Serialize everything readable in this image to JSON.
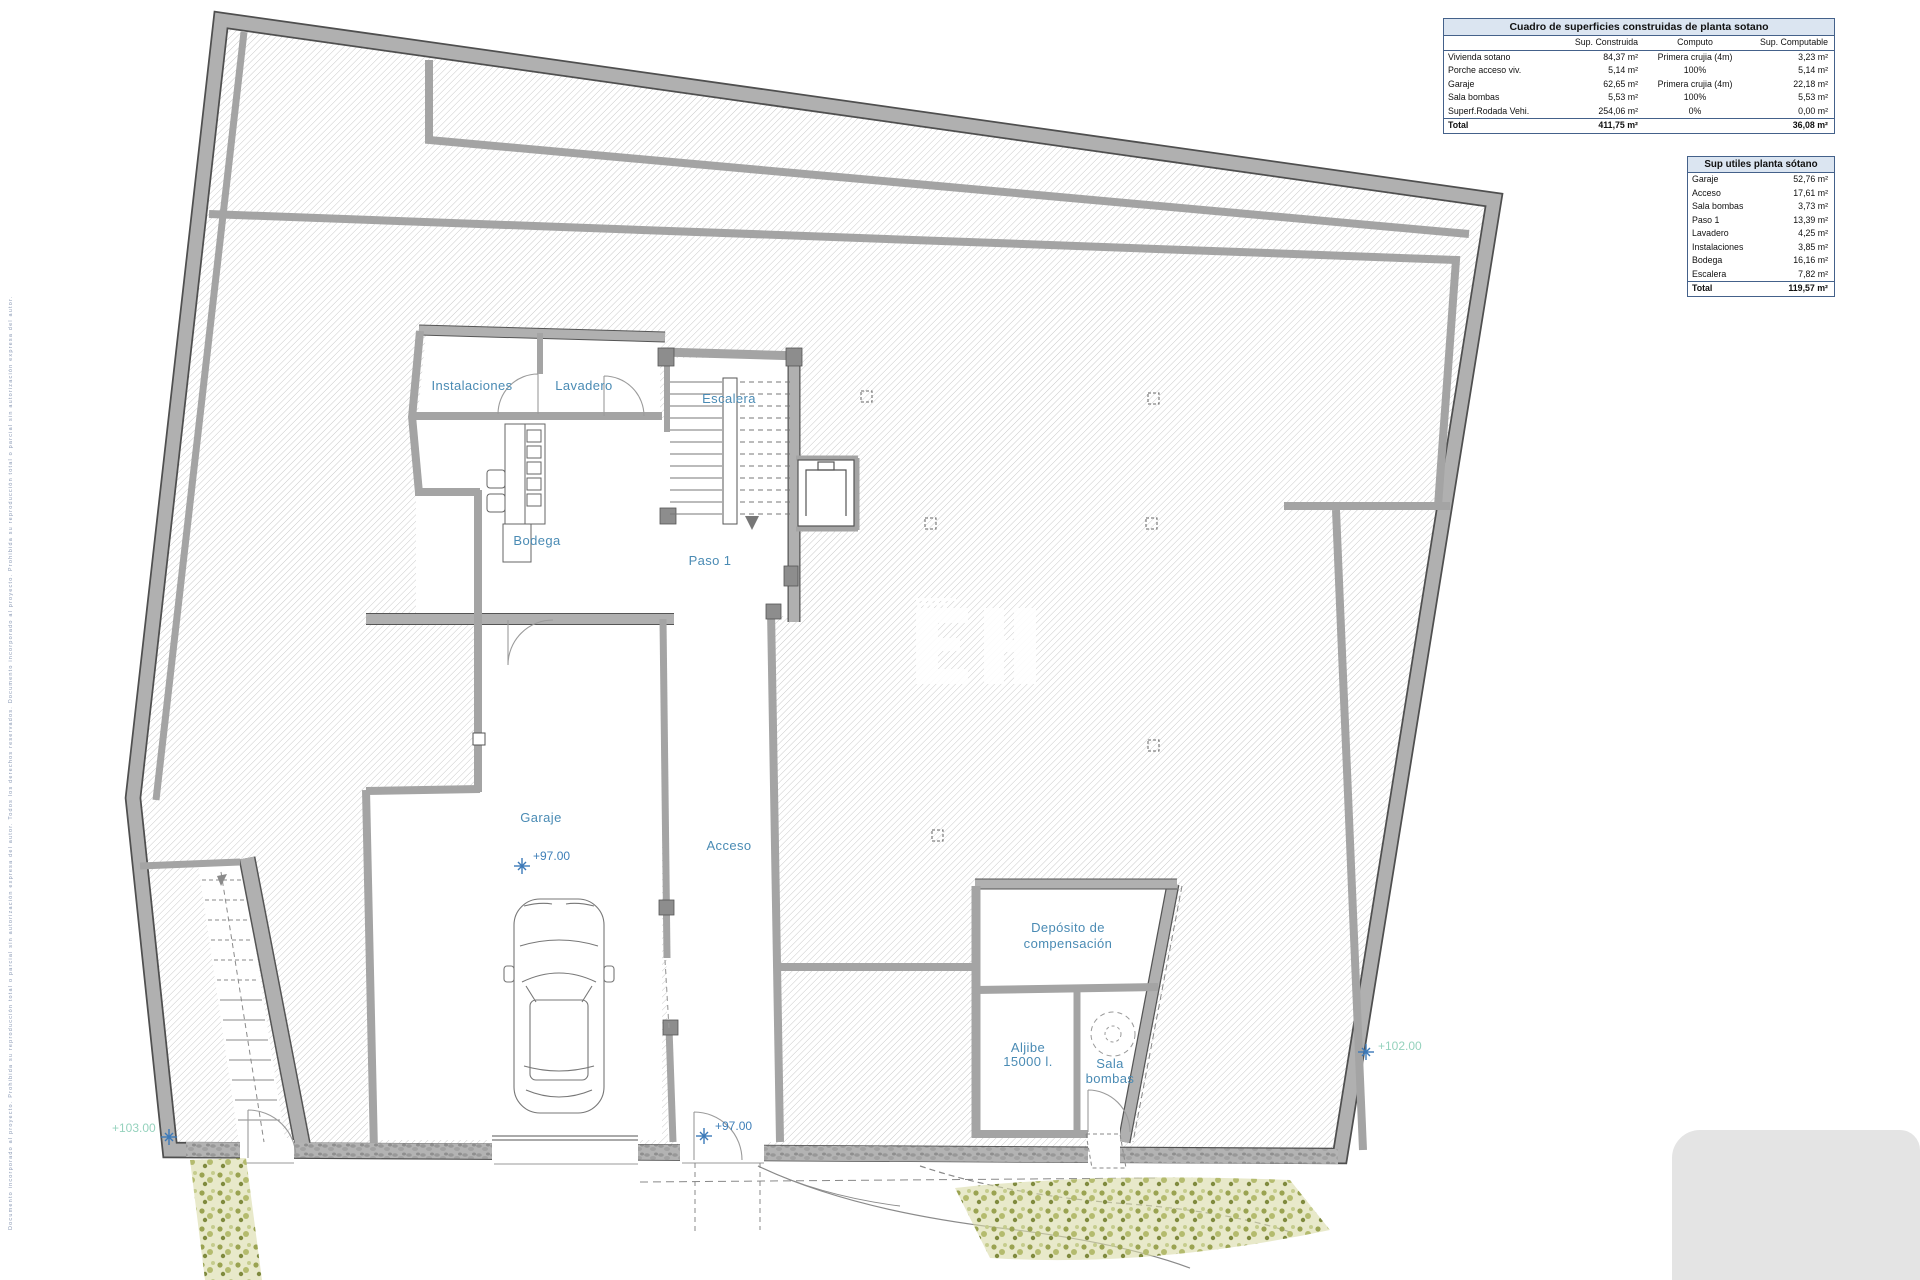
{
  "tables": {
    "t1": {
      "title": "Cuadro de superficies construidas de planta sotano",
      "headers": [
        "Sup. Construida",
        "Computo",
        "Sup. Computable"
      ],
      "rows": [
        [
          "Vivienda sotano",
          "84,37 m²",
          "Primera crujia (4m)",
          "3,23 m²"
        ],
        [
          "Porche acceso viv.",
          "5,14 m²",
          "100%",
          "5,14 m²"
        ],
        [
          "Garaje",
          "62,65 m²",
          "Primera crujia (4m)",
          "22,18 m²"
        ],
        [
          "Sala bombas",
          "5,53 m²",
          "100%",
          "5,53 m²"
        ],
        [
          "Superf.Rodada Vehi.",
          "254,06 m²",
          "0%",
          "0,00 m²"
        ]
      ],
      "total": [
        "Total",
        "411,75 m²",
        "",
        "36,08 m²"
      ]
    },
    "t2": {
      "title": "Sup utiles planta sótano",
      "rows": [
        [
          "Garaje",
          "52,76 m²"
        ],
        [
          "Acceso",
          "17,61 m²"
        ],
        [
          "Sala bombas",
          "3,73 m²"
        ],
        [
          "Paso 1",
          "13,39 m²"
        ],
        [
          "Lavadero",
          "4,25 m²"
        ],
        [
          "Instalaciones",
          "3,85 m²"
        ],
        [
          "Bodega",
          "16,16 m²"
        ],
        [
          "Escalera",
          "7,82 m²"
        ]
      ],
      "total": [
        "Total",
        "119,57 m²"
      ]
    }
  },
  "plan": {
    "labels": {
      "instalaciones": "Instalaciones",
      "lavadero": "Lavadero",
      "escalera": "Escalera",
      "bodega": "Bodega",
      "paso": "Paso 1",
      "garaje": "Garaje",
      "acceso": "Acceso",
      "deposito_l1": "Depósito de",
      "deposito_l2": "compensación",
      "aljibe_l1": "Aljibe",
      "aljibe_l2": "15000 l.",
      "sala_l1": "Sala",
      "sala_l2": "bombas"
    },
    "levels": {
      "garaje": "+97.00",
      "salida": "+97.00",
      "este": "+102.00",
      "oeste": "+103.00"
    }
  },
  "watermark": "EH",
  "margin_note": "Documento incorporado al proyecto. Prohibida su reproducción total o parcial sin autorización expresa del autor. Todos los derechos reservados. Documento incorporado al proyecto. Prohibida su reproducción total o parcial sin autorización expresa del autor.",
  "colors": {
    "wall": "#b0b0b0",
    "hatch": "#c5c5c5",
    "label_blue": "#4a8bb4",
    "level_green": "#95d2bd",
    "marker_blue": "#3c79b8",
    "table_header_bg": "#dbe5f1",
    "vegetation": "#a8ad5e"
  }
}
